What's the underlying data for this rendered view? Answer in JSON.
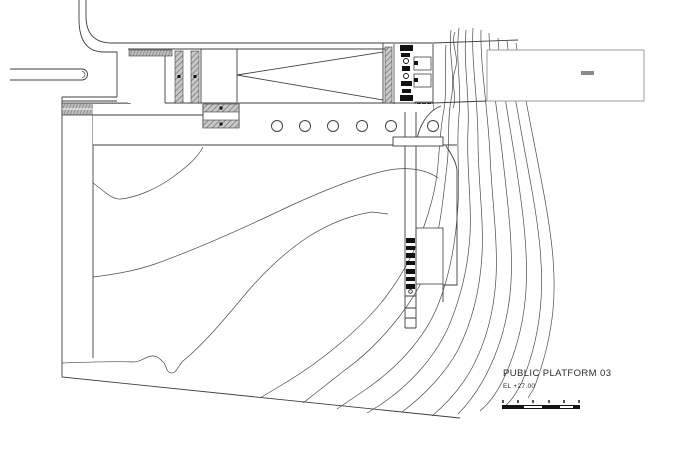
{
  "title_block": {
    "title": "PUBLIC PLATFORM 03",
    "elevation": "EL +27.00"
  },
  "scale_bar": {
    "tick_count": 6,
    "segments": [
      {
        "width": 22,
        "tone": "dark"
      },
      {
        "width": 18,
        "tone": "light"
      },
      {
        "width": 18,
        "tone": "dark"
      },
      {
        "width": 14,
        "tone": "light"
      },
      {
        "width": 6,
        "tone": "dark"
      }
    ],
    "dark_color": "#161616",
    "light_color": "#ffffff"
  },
  "colors": {
    "background": "#ffffff",
    "main_line": "#3f3f3f",
    "contour_line": "#4a4a4a",
    "light_line": "#9e9e9e",
    "hatch_fill": "#8f8f8f"
  }
}
